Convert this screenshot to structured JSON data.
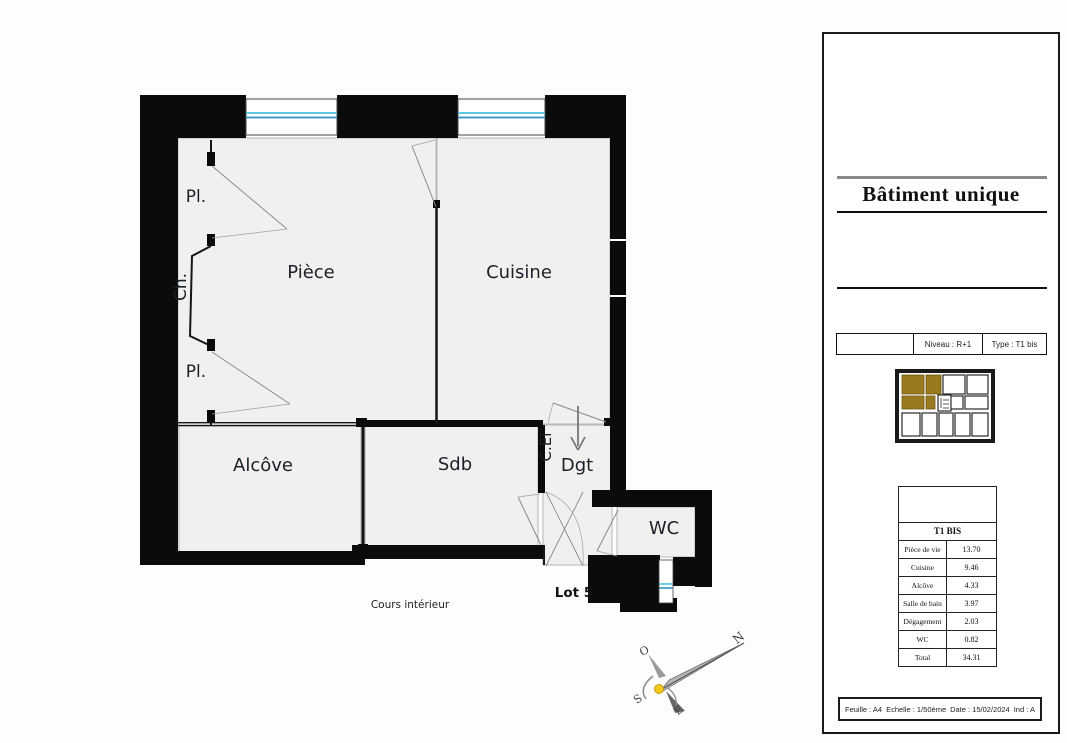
{
  "plan": {
    "labels": {
      "pl_top": "Pl.",
      "ch": "Ch.",
      "pl_bottom": "Pl.",
      "piece": "Pièce",
      "cuisine": "Cuisine",
      "alcove": "Alcôve",
      "sdb": "Sdb",
      "cel": "C.El",
      "dgt": "Dgt",
      "wc": "WC",
      "lot": "Lot 5",
      "courtyard": "Cours intérieur"
    },
    "compass": {
      "north": "N",
      "west": "O",
      "south": "S",
      "east": "E"
    }
  },
  "panel": {
    "building_title": "Bâtiment unique",
    "info_row": {
      "niveau": "Niveau : R+1",
      "type": "Type : T1 bis"
    },
    "area_table": {
      "header": "T1 BIS",
      "rows": [
        {
          "label": "Pièce de vie",
          "value": "13.70"
        },
        {
          "label": "Cuisine",
          "value": "9.46"
        },
        {
          "label": "Alcôve",
          "value": "4.33"
        },
        {
          "label": "Salle de bain",
          "value": "3.97"
        },
        {
          "label": "Dégagement",
          "value": "2.03"
        },
        {
          "label": "WC",
          "value": "0.82"
        },
        {
          "label": "Total",
          "value": "34.31"
        }
      ]
    },
    "footer": {
      "sheet": "Feuille : A4",
      "scale": "Echelle : 1/50ème",
      "date": "Date : 15/02/2024",
      "ind": "Ind : A"
    }
  },
  "colors": {
    "wall": "#0b0b0b",
    "room_fill": "#f0f0ee",
    "glazing_light": "#4cc0db",
    "glazing_dark": "#2f93c4",
    "highlight_brown": "#9a7a1e",
    "compass_yellow": "#f2c81f"
  }
}
